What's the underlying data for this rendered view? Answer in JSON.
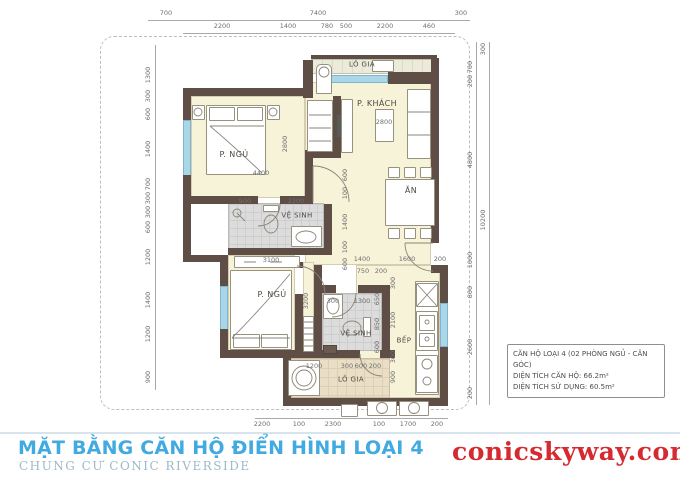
{
  "footer": {
    "title": "MẶT BẰNG CĂN HỘ ĐIỂN HÌNH LOẠI 4",
    "subtitle": "CHUNG CƯ CONIC RIVERSIDE",
    "website": "conicskyway.com"
  },
  "info_box": {
    "line1": "CĂN HỘ LOẠI 4 (02 PHÒNG NGỦ - CĂN GÓC)",
    "line2": "DIỆN TÍCH CĂN HỘ: 66.2m²",
    "line3": "DIỆN TÍCH SỬ DỤNG: 60.5m²"
  },
  "rooms": {
    "bedroom1": "P. NGỦ",
    "living": "P. KHÁCH",
    "loggia1": "LÔ GIA",
    "bath1": "VỆ SINH",
    "dining": "ĂN",
    "bedroom2": "P. NGỦ",
    "bath2": "VỆ SINH",
    "kitchen": "BẾP",
    "loggia2": "LÔ GIA"
  },
  "dims": {
    "top_outer": [
      "700",
      "7400",
      "300"
    ],
    "top_inner": [
      "2200",
      "1400",
      "780",
      "500",
      "2200",
      "460"
    ],
    "left": [
      "1300",
      "300",
      "600",
      "1400",
      "700",
      "300",
      "300",
      "600",
      "1200",
      "1400",
      "1200",
      "900"
    ],
    "right": [
      "300",
      "700",
      "200",
      "4800",
      "1000",
      "800",
      "2600",
      "200"
    ],
    "right_total": "10200",
    "bottom": [
      "2200",
      "100",
      "2300",
      "100",
      "1700",
      "200"
    ],
    "interior": {
      "bed1_w": "4400",
      "bed1_h": "2800",
      "coffee_table": "2800",
      "bath1_w1": "900",
      "bath1_w2": "2200",
      "hall_w": "3100",
      "bed2_h": "3200",
      "chain_a": "600",
      "chain_b": "100",
      "chain_c": "1400",
      "chain_d": "100",
      "chain_e": "600",
      "row_a": "1400",
      "row_b": "1600",
      "row_c": "200",
      "row_d": "750",
      "row_e": "200",
      "bath2_a": "300",
      "bath2_b": "1300",
      "bath2_c": "650",
      "bath2_d": "850",
      "bath2_e": "600",
      "kit_a": "300",
      "kit_b": "2100",
      "kit_c": "300",
      "kit_d": "900",
      "log2_a": "1200",
      "log2_b": "300",
      "log2_c": "600",
      "log2_d": "200"
    }
  },
  "colors": {
    "wall": "#5e4e45",
    "floor": "#f7f3d8",
    "bath_floor": "#dcdcdc",
    "loggia_floor": "#eadfc6",
    "window": "#a9d7e8",
    "title_blue": "#41aae1",
    "website_red": "#d42a30"
  }
}
